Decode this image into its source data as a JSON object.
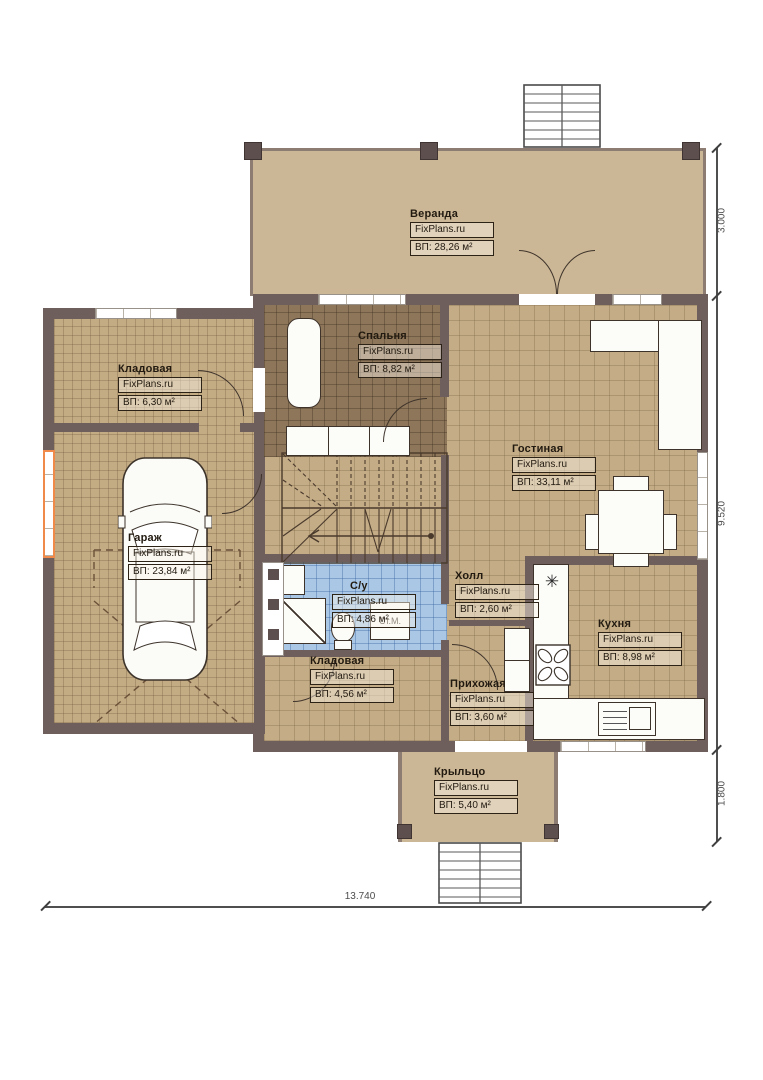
{
  "plan": {
    "brand": "FixPlans.ru",
    "rooms": {
      "veranda": {
        "name": "Веранда",
        "brand": "FixPlans.ru",
        "area": "ВП: 28,26 м²"
      },
      "bedroom": {
        "name": "Спальня",
        "brand": "FixPlans.ru",
        "area": "ВП: 8,82 м²"
      },
      "storage_top": {
        "name": "Кладовая",
        "brand": "FixPlans.ru",
        "area": "ВП: 6,30 м²"
      },
      "garage": {
        "name": "Гараж",
        "brand": "FixPlans.ru",
        "area": "ВП: 23,84 м²"
      },
      "living": {
        "name": "Гостиная",
        "brand": "FixPlans.ru",
        "area": "ВП: 33,11 м²"
      },
      "bathroom": {
        "name": "С/у",
        "brand": "FixPlans.ru",
        "area": "ВП: 4,86 м²"
      },
      "hall": {
        "name": "Холл",
        "brand": "FixPlans.ru",
        "area": "ВП: 2,60 м²"
      },
      "kitchen": {
        "name": "Кухня",
        "brand": "FixPlans.ru",
        "area": "ВП: 8,98 м²"
      },
      "storage_bottom": {
        "name": "Кладовая",
        "brand": "FixPlans.ru",
        "area": "ВП: 4,56 м²"
      },
      "entry": {
        "name": "Прихожая",
        "brand": "FixPlans.ru",
        "area": "ВП: 3,60 м²"
      },
      "porch": {
        "name": "Крыльцо",
        "brand": "FixPlans.ru",
        "area": "ВП: 5,40 м²"
      }
    },
    "annotations": {
      "washing_machine": "Ст.М.",
      "stove_symbol": "✳"
    },
    "dimensions": {
      "veranda_depth": "3.000",
      "house_depth": "9.520",
      "porch_depth": "1.800",
      "total_width": "13.740"
    },
    "colors": {
      "wall": "#6f5f5c",
      "floor_tan": "#c3ac86",
      "floor_bedroom": "#8d7659",
      "floor_bathroom": "#aac8e5",
      "floor_veranda": "#cbb795",
      "window_accent": "#ef8a4b"
    }
  }
}
